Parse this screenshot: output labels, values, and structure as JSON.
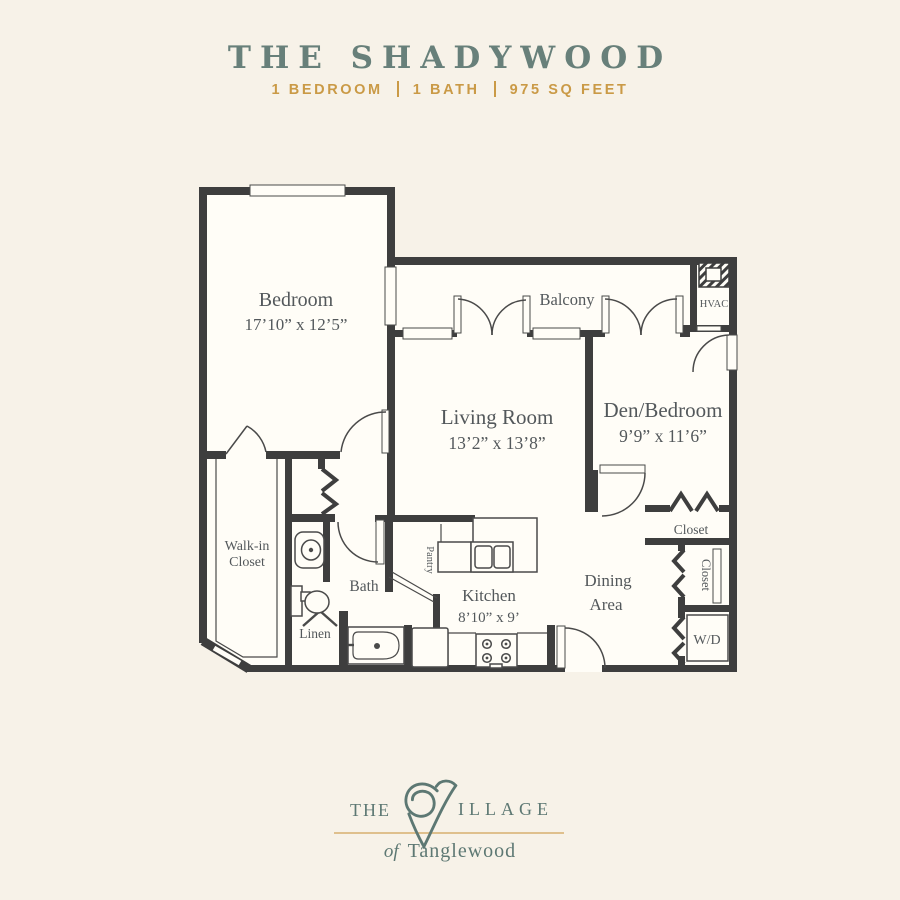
{
  "header": {
    "title": "THE SHADYWOOD",
    "specs": [
      "1 BEDROOM",
      "1 BATH",
      "975 SQ FEET"
    ]
  },
  "floorplan": {
    "rooms": {
      "bedroom": {
        "name": "Bedroom",
        "dims": "17’10” x 12’5”"
      },
      "living": {
        "name": "Living Room",
        "dims": "13’2” x 13’8”"
      },
      "den": {
        "name": "Den/Bedroom",
        "dims": "9’9” x 11’6”"
      },
      "kitchen": {
        "name": "Kitchen",
        "dims": "8’10” x 9’"
      },
      "dining": {
        "line1": "Dining",
        "line2": "Area"
      },
      "balcony": "Balcony",
      "hvac": "HVAC",
      "walkin": {
        "line1": "Walk-in",
        "line2": "Closet"
      },
      "bath": "Bath",
      "linen": "Linen",
      "pantry": "Pantry",
      "closet_top": "Closet",
      "closet_side": "Closet",
      "wd": "W/D"
    }
  },
  "logo": {
    "the": "THE",
    "illage": "ILLAGE",
    "of": "of",
    "name": "Tanglewood"
  },
  "colors": {
    "background": "#f7f2e8",
    "paper": "#fffdf7",
    "wall": "#3e3e3e",
    "title_teal": "#68807a",
    "accent_gold": "#ca9a46",
    "label_gray": "#53585b",
    "logo_teal": "#5d7873",
    "logo_gold_line": "#dfc08d"
  }
}
